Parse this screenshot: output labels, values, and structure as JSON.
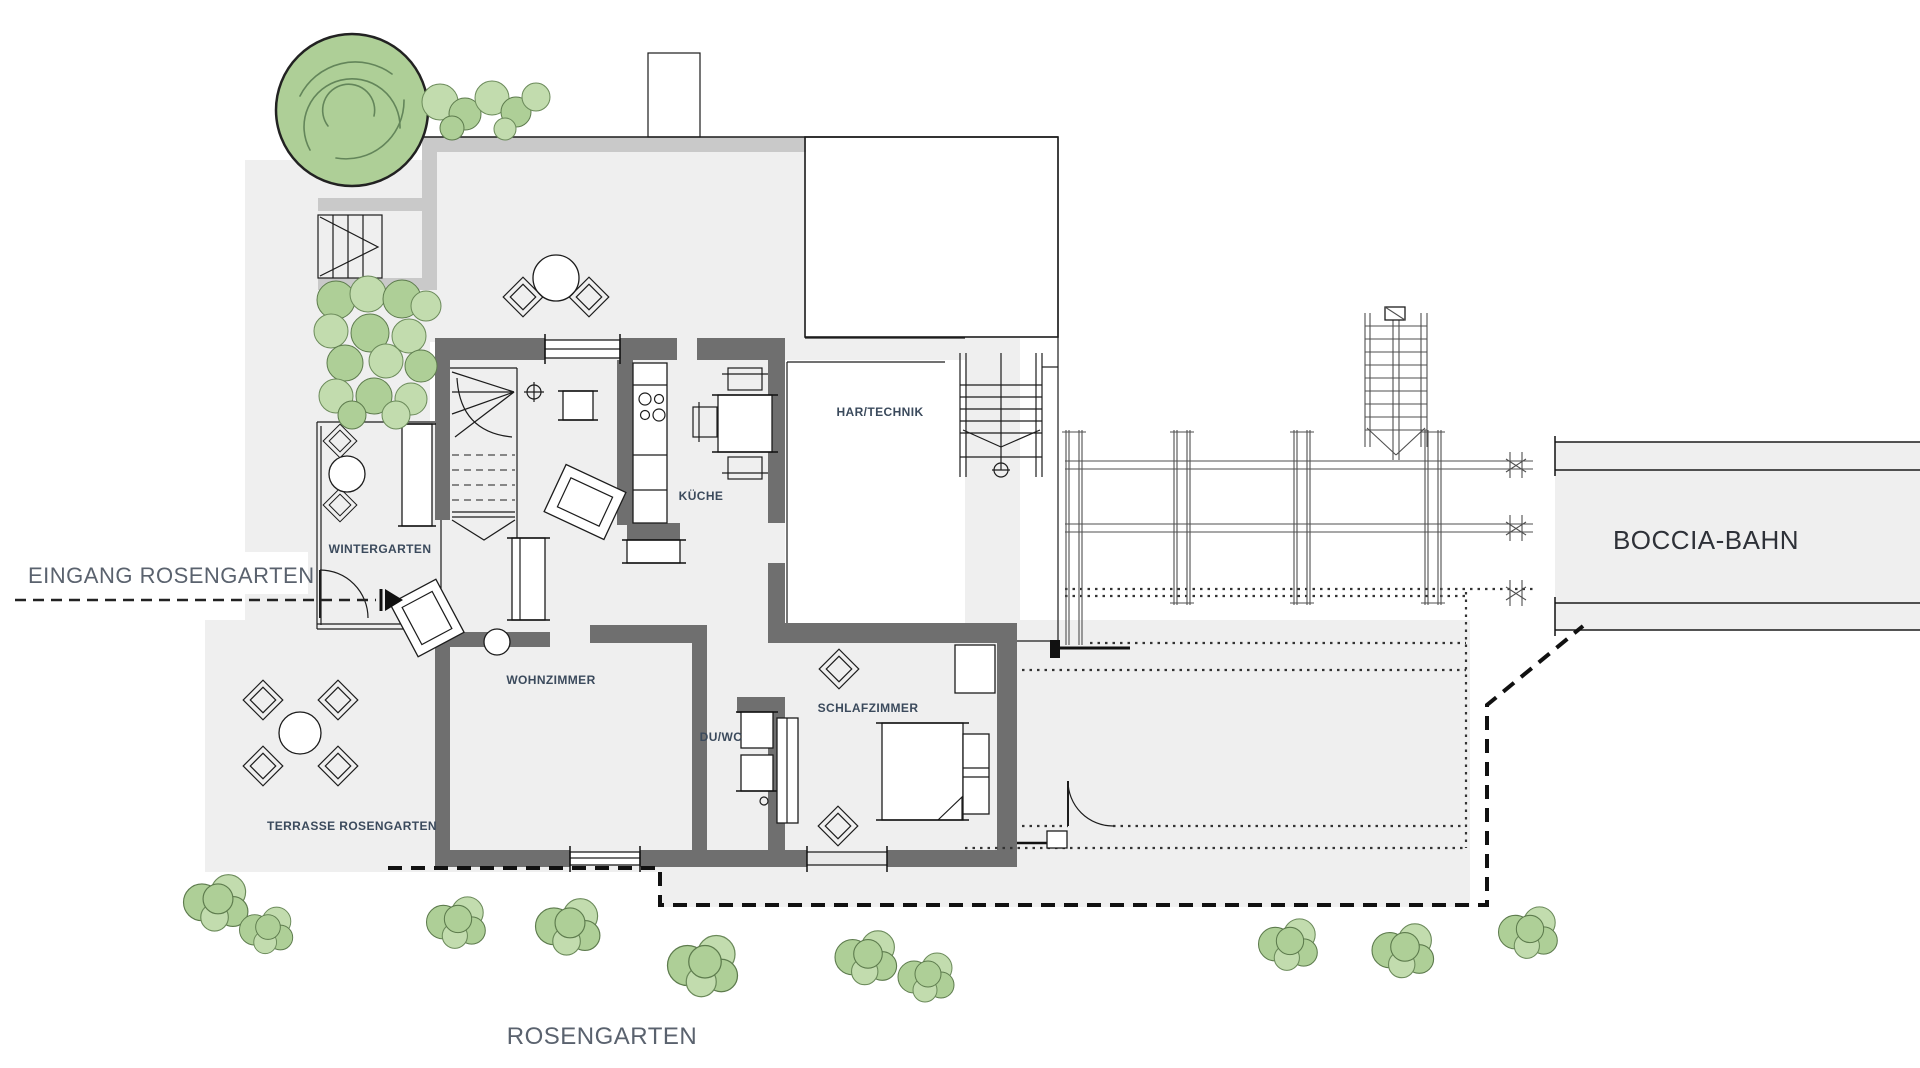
{
  "drawing": {
    "type": "architectural-floor-plan",
    "labels": {
      "eingang": "EINGANG ROSENGARTEN",
      "wintergarten": "WINTERGARTEN",
      "terrasse": "TERRASSE ROSENGARTEN",
      "wohnzimmer": "WOHNZIMMER",
      "kueche": "KÜCHE",
      "du_wc": "DU/WC",
      "schlafzimmer": "SCHLAFZIMMER",
      "haus_technik": "HAR/TECHNIK",
      "boccia": "BOCCIA-BAHN",
      "rosengarten": "ROSENGARTEN"
    },
    "colors": {
      "site_fill": "#efefef",
      "terrace_band": "#c9c9c9",
      "wall_fill": "#6f6f6f",
      "line": "#1c1c1c",
      "label_small": "#3b4a5c",
      "label_large": "#5a626e",
      "label_boccia": "#2e3138",
      "foliage_fill": "#aecf97",
      "foliage_stroke": "#5d7b4d"
    }
  }
}
